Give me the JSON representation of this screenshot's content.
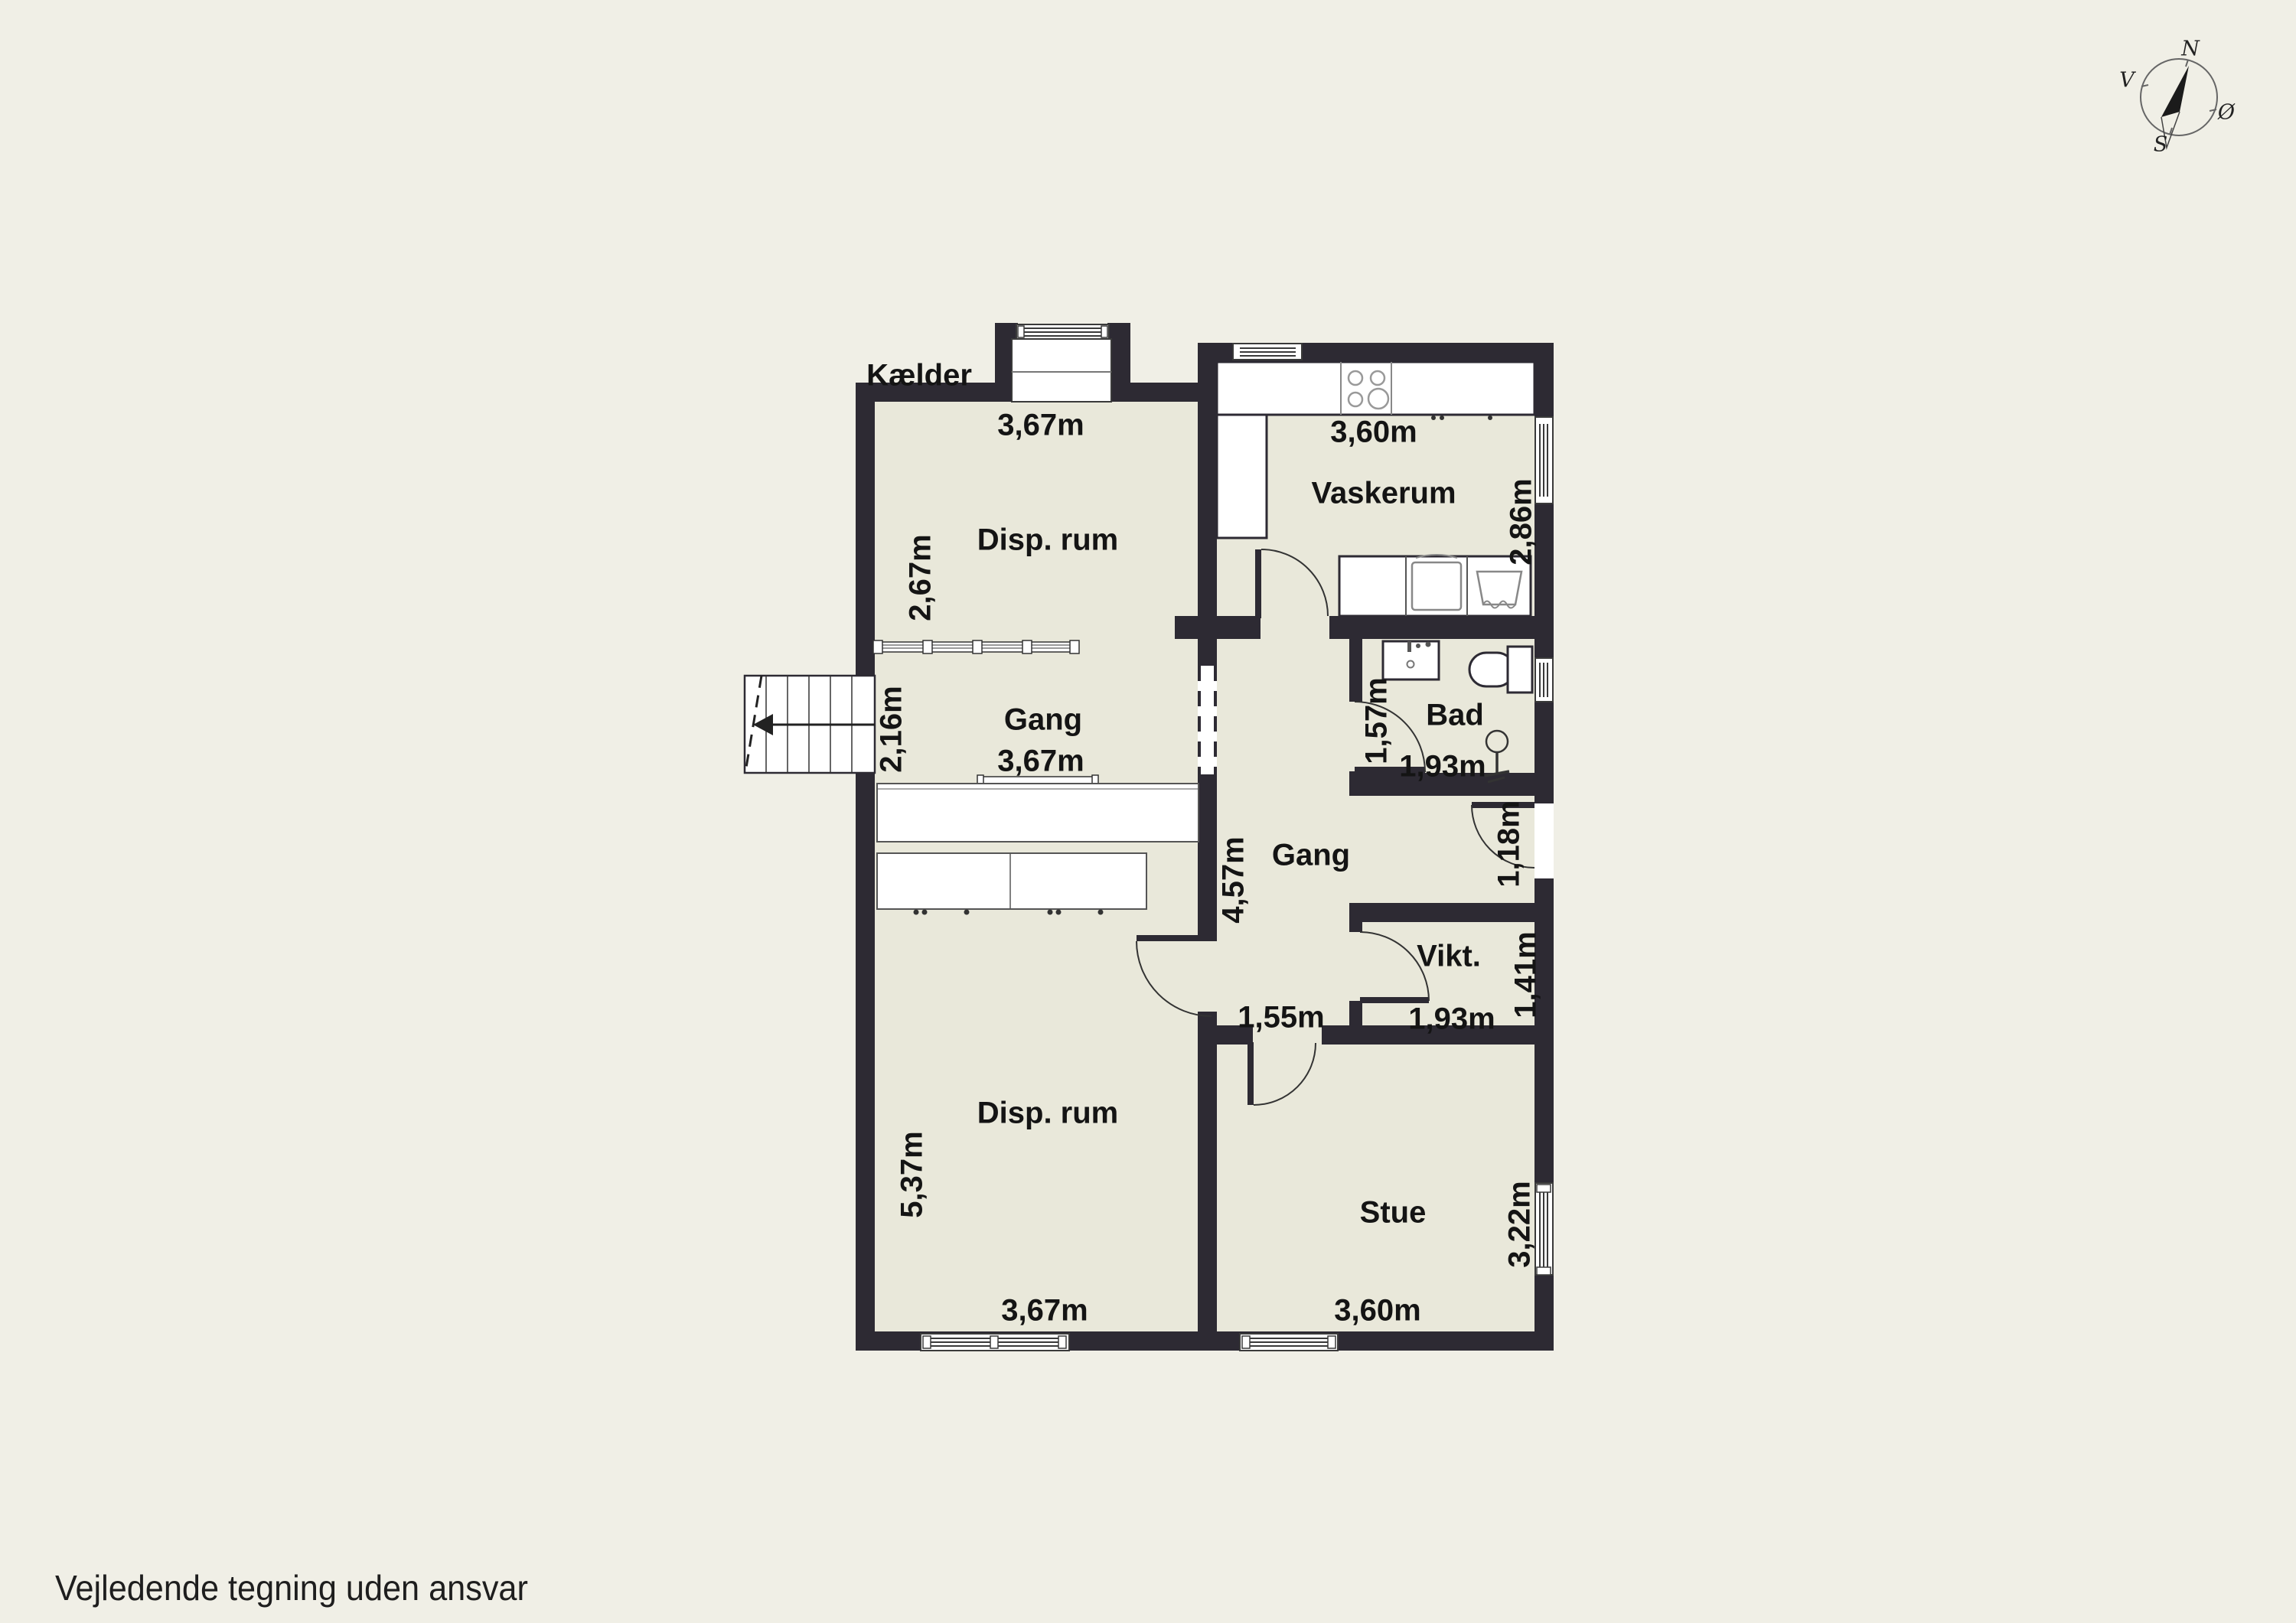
{
  "page": {
    "title": "Kælder",
    "disclaimer": "Vejledende tegning uden ansvar"
  },
  "compass": {
    "north": "N",
    "south": "S",
    "west": "V",
    "east": "Ø"
  },
  "rooms": {
    "disp_rum_top": {
      "name": "Disp. rum",
      "width": "3,67m",
      "depth": "2,67m"
    },
    "gang_left": {
      "name": "Gang",
      "width": "3,67m",
      "stair_width": "2,16m"
    },
    "vaskerum": {
      "name": "Vaskerum",
      "width": "3,60m",
      "depth": "2,86m"
    },
    "bad": {
      "name": "Bad",
      "width": "1,93m",
      "depth": "1,57m"
    },
    "gang_right": {
      "name": "Gang",
      "length": "4,57m",
      "entry_width": "1,18m",
      "passage_width": "1,55m"
    },
    "vikt": {
      "name": "Vikt.",
      "width": "1,93m",
      "depth": "1,41m"
    },
    "disp_rum_bottom": {
      "name": "Disp. rum",
      "width": "3,67m",
      "depth": "5,37m"
    },
    "stue": {
      "name": "Stue",
      "width": "3,60m",
      "depth": "3,22m"
    }
  },
  "colors": {
    "background": "#f0efe6",
    "floor": "#e9e8da",
    "wall": "#2d2a33",
    "text": "#141414"
  }
}
